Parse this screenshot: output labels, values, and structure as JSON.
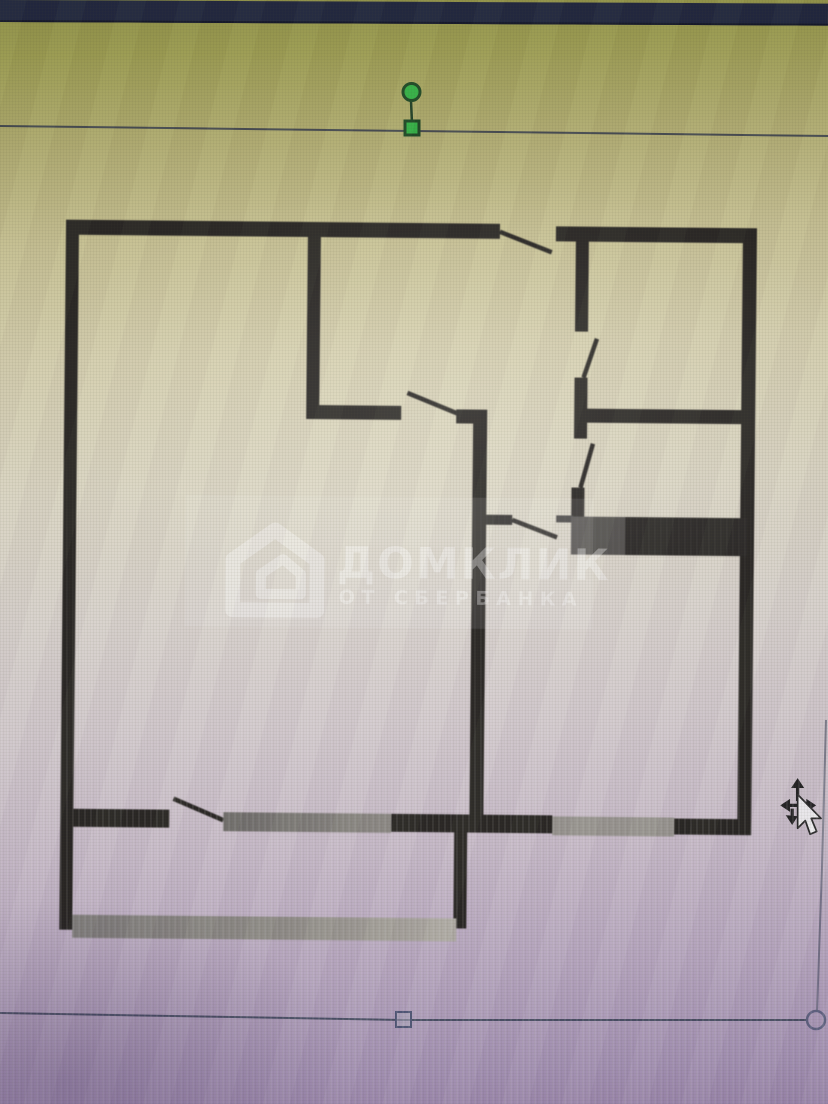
{
  "editor": {
    "canvas_object": "apartment-floor-plan-image",
    "selection_state": "selected"
  },
  "watermark": {
    "line1": "ДОМКЛИК",
    "line2": "ОТ СБЕРБАНКА",
    "logo": "domclick-house-logo"
  },
  "selection": {
    "rotation_handle": "green-rotate-handle",
    "top_middle_handle": "green-square-handle",
    "bottom_middle_handle": "gray-square-handle",
    "bottom_right_handle": "gray-circle-handle"
  },
  "cursor": {
    "type": "move-cursor"
  },
  "floor_plan": {
    "rooms": [
      "living-room",
      "entry-hall",
      "bathroom",
      "bedroom",
      "corridor",
      "balcony"
    ],
    "features": [
      "entrance-door-swing",
      "hall-door-swing",
      "bathroom-door-swing",
      "bedroom-door-swing",
      "balcony-door-swing",
      "closet-block",
      "windows"
    ]
  },
  "colors": {
    "topbar": "#1a2138",
    "topbar-edge": "#0d1122",
    "wall": "#201e1a",
    "window-dark": "#6f6d69",
    "window-light": "#97948e",
    "closet-light": "#4d4b48",
    "closet-dark": "#23211e",
    "selection-line": "#3a4258",
    "handle-green": "#2db23f",
    "handle-green-dark": "#16431c",
    "handle-gray-fill": "#aba8be",
    "handle-gray-border": "#4a5273",
    "watermark-white": "rgba(255,255,255,0.35)",
    "cursor-black": "#1c1c1c",
    "cursor-white": "#f4f3f5"
  }
}
